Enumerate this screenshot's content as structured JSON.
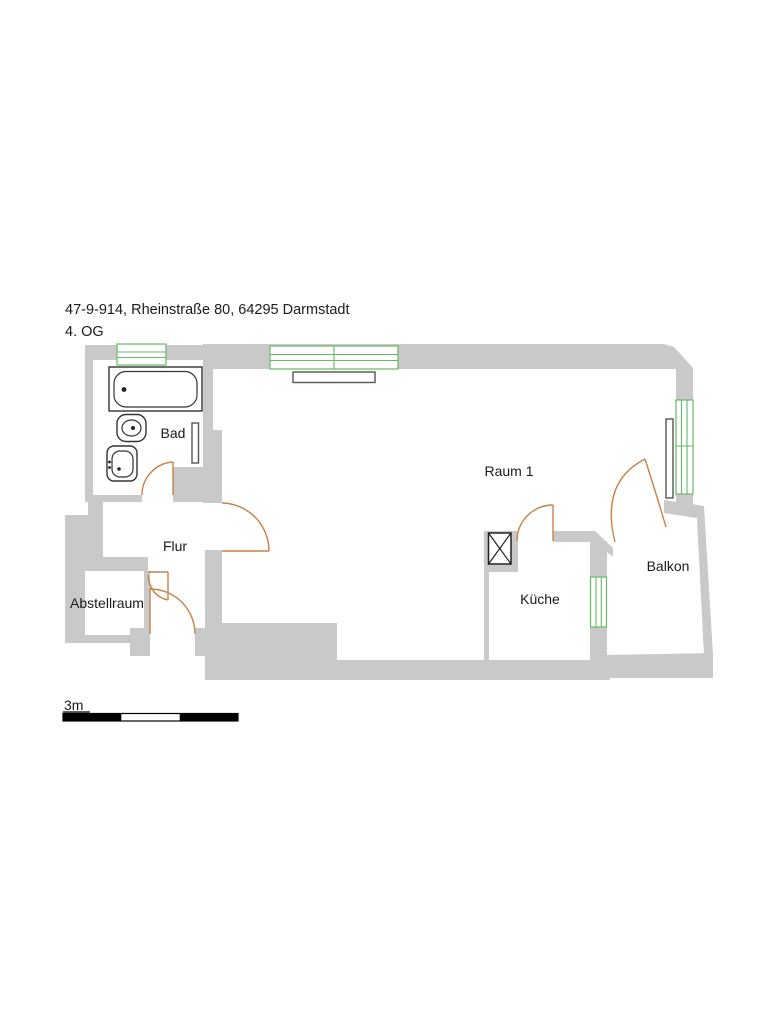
{
  "header": {
    "address": "47-9-914, Rheinstraße 80, 64295 Darmstadt",
    "floor": "4. OG"
  },
  "rooms": {
    "bad": "Bad",
    "flur": "Flur",
    "abstellraum": "Abstellraum",
    "raum1": "Raum 1",
    "kueche": "Küche",
    "balkon": "Balkon"
  },
  "scale": {
    "label": "3m",
    "length_meters": 3
  },
  "legend": {
    "wall_color": "#c9c9c9",
    "window_color": "#66b966",
    "door_color": "#c98147",
    "fixture_color": "#333333",
    "text_color": "#1a1a1a"
  }
}
